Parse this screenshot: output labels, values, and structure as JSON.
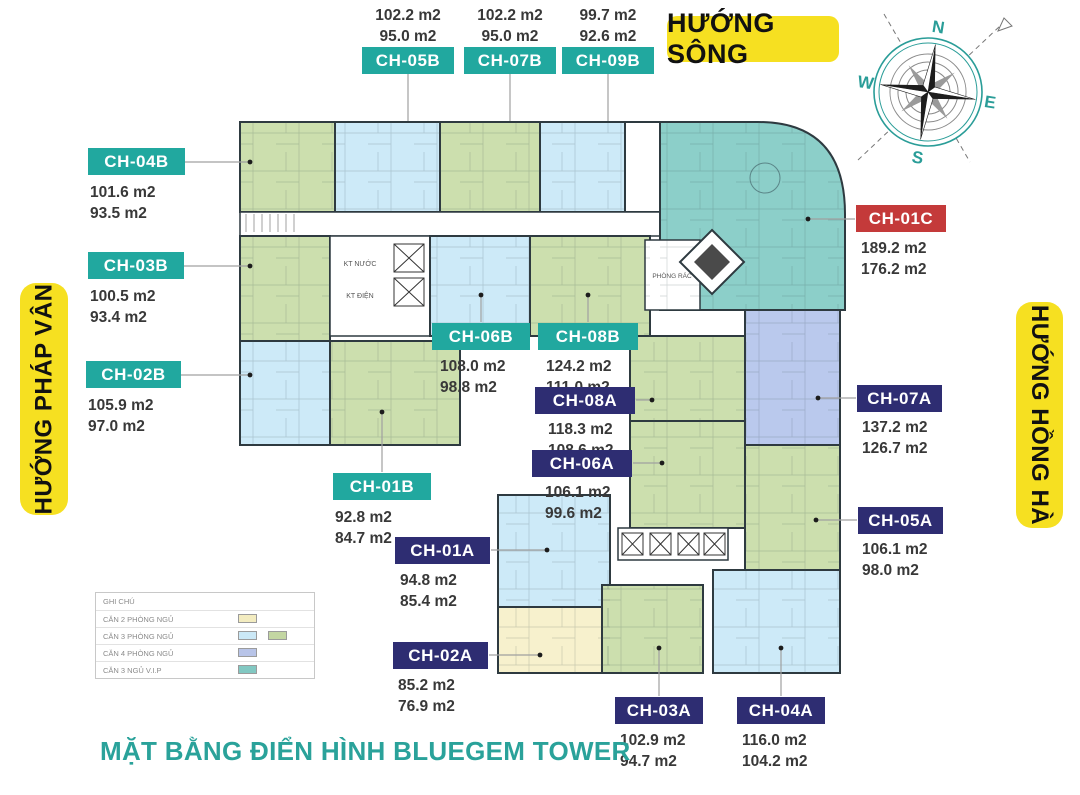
{
  "caption": "MẶT BẰNG ĐIỂN HÌNH BLUEGEM TOWER",
  "banners": {
    "river": "HƯỚNG SÔNG",
    "phap_van": "HƯỚNG PHÁP VÂN",
    "hong_ha": "HƯỚNG HỒNG HÀ"
  },
  "compass": {
    "n": "N",
    "e": "E",
    "s": "S",
    "w": "W"
  },
  "legend": {
    "title": "GHI CHÚ",
    "items": [
      {
        "label": "CĂN 2 PHÒNG NGỦ",
        "colors": [
          "#f3ecc0"
        ]
      },
      {
        "label": "CĂN 3 PHÒNG NGỦ",
        "colors": [
          "#cbe8f6",
          "#c3d6a2"
        ]
      },
      {
        "label": "CĂN 4 PHÒNG NGỦ",
        "colors": [
          "#b8c4e8"
        ]
      },
      {
        "label": "CĂN 3 NGỦ V.I.P",
        "colors": [
          "#82c8c2"
        ]
      }
    ]
  },
  "plan_labels": {
    "kt_nuoc": "KT NƯỚC",
    "kt_dien": "KT ĐIỆN",
    "phong_rac": "PHÒNG RÁC"
  },
  "units": [
    {
      "id": "CH-04B",
      "area_gross": "101.6 m2",
      "area_net": "93.5 m2"
    },
    {
      "id": "CH-05B",
      "area_gross": "102.2 m2",
      "area_net": "95.0 m2"
    },
    {
      "id": "CH-07B",
      "area_gross": "102.2 m2",
      "area_net": "95.0 m2"
    },
    {
      "id": "CH-09B",
      "area_gross": "99.7 m2",
      "area_net": "92.6 m2"
    },
    {
      "id": "CH-03B",
      "area_gross": "100.5 m2",
      "area_net": "93.4 m2"
    },
    {
      "id": "CH-02B",
      "area_gross": "105.9 m2",
      "area_net": "97.0 m2"
    },
    {
      "id": "CH-01B",
      "area_gross": "92.8 m2",
      "area_net": "84.7 m2"
    },
    {
      "id": "CH-06B",
      "area_gross": "108.0 m2",
      "area_net": "98.8 m2"
    },
    {
      "id": "CH-08B",
      "area_gross": "124.2 m2",
      "area_net": "111.0 m2"
    },
    {
      "id": "CH-01C",
      "area_gross": "189.2 m2",
      "area_net": "176.2 m2"
    },
    {
      "id": "CH-08A",
      "area_gross": "118.3 m2",
      "area_net": "108.6 m2"
    },
    {
      "id": "CH-06A",
      "area_gross": "106.1 m2",
      "area_net": "99.6 m2"
    },
    {
      "id": "CH-07A",
      "area_gross": "137.2 m2",
      "area_net": "126.7 m2"
    },
    {
      "id": "CH-05A",
      "area_gross": "106.1 m2",
      "area_net": "98.0 m2"
    },
    {
      "id": "CH-01A",
      "area_gross": "94.8 m2",
      "area_net": "85.4 m2"
    },
    {
      "id": "CH-02A",
      "area_gross": "85.2 m2",
      "area_net": "76.9 m2"
    },
    {
      "id": "CH-03A",
      "area_gross": "102.9 m2",
      "area_net": "94.7 m2"
    },
    {
      "id": "CH-04A",
      "area_gross": "116.0 m2",
      "area_net": "104.2 m2"
    }
  ],
  "colors": {
    "chip_teal": "#21a89f",
    "chip_navy": "#2e2d72",
    "chip_red": "#c43a3a",
    "banner_yellow": "#f6e021",
    "title_teal": "#2aa29a",
    "unit_green": "#ccdfae",
    "unit_blue": "#cdeaf8",
    "unit_yellow": "#f7f1cd",
    "unit_lavender": "#bac9ed",
    "unit_teal_vip": "#8ccfc9"
  }
}
